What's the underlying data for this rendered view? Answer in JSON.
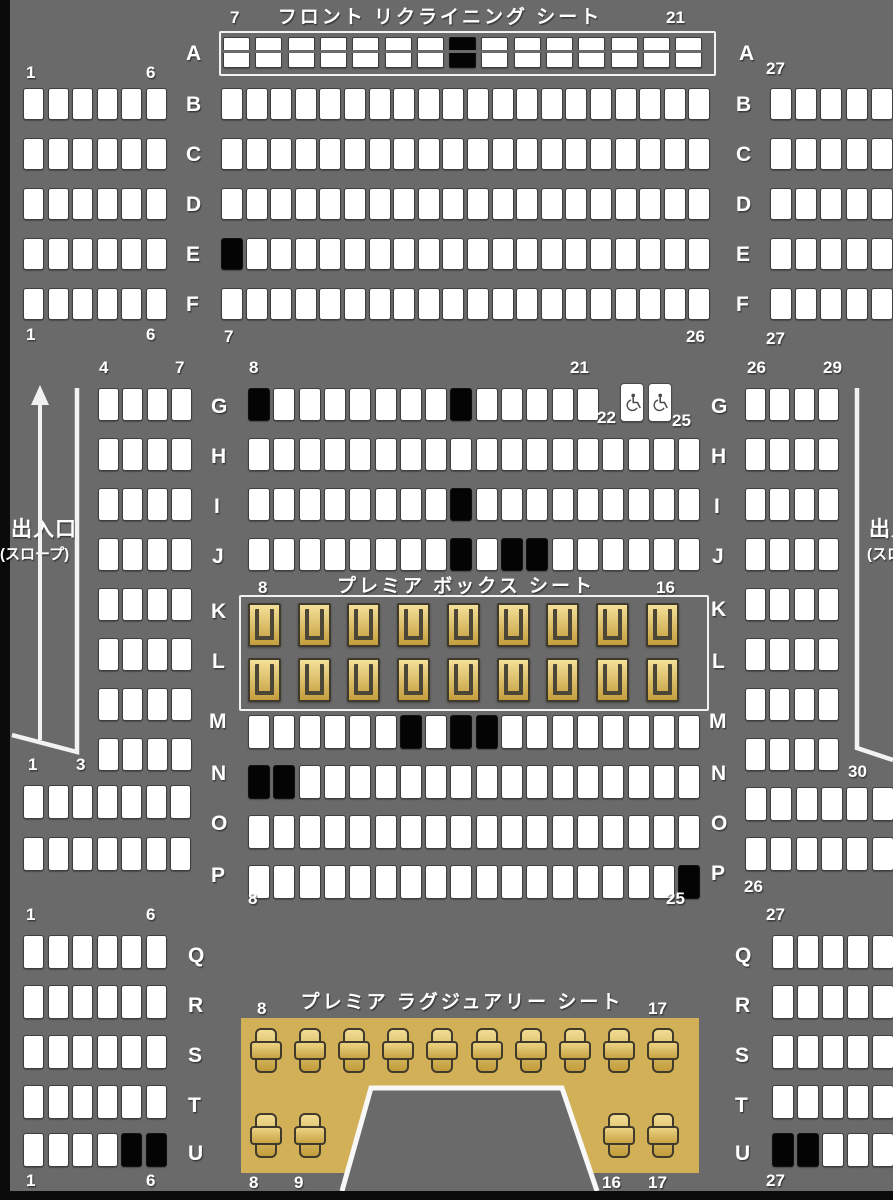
{
  "titles": {
    "front": "フロント リクライニング シート",
    "box": "プレミア ボックス シート",
    "luxury": "プレミア ラグジュアリー シート"
  },
  "exits": {
    "left": {
      "line1": "出入口",
      "line2": "(スロープ)"
    },
    "right": {
      "line1": "出入口",
      "line2": "(スロープ)"
    }
  },
  "colors": {
    "background": "#6a6a6a",
    "seat_available": "#ffffff",
    "seat_occupied": "#040404",
    "seat_border": "#3e3e3e",
    "premium_gold_light": "#f4e098",
    "premium_gold_dark": "#c49e3c",
    "luxury_area": "#d2b057",
    "label_text": "#ffffff",
    "frame_border": "#f2f2f2"
  },
  "blocks": [
    {
      "id": "front-A",
      "type": "recliner",
      "x": 223,
      "pitch": 32.3,
      "w": 27,
      "h": 31,
      "rows": [
        {
          "row": "A",
          "y": 37,
          "start": 7,
          "count": 15,
          "occupied": [
            14
          ]
        }
      ]
    },
    {
      "id": "left-BF",
      "type": "standard",
      "x": 23,
      "pitch": 24.5,
      "w": 21,
      "h": 32,
      "rows": [
        {
          "row": "B",
          "y": 88,
          "start": 1,
          "count": 6,
          "occupied": []
        },
        {
          "row": "C",
          "y": 138,
          "start": 1,
          "count": 6,
          "occupied": []
        },
        {
          "row": "D",
          "y": 188,
          "start": 1,
          "count": 6,
          "occupied": []
        },
        {
          "row": "E",
          "y": 238,
          "start": 1,
          "count": 6,
          "occupied": []
        },
        {
          "row": "F",
          "y": 288,
          "start": 1,
          "count": 6,
          "occupied": []
        }
      ]
    },
    {
      "id": "center-BF",
      "type": "standard",
      "x": 221,
      "pitch": 24.6,
      "w": 22,
      "h": 32,
      "rows": [
        {
          "row": "B",
          "y": 88,
          "start": 7,
          "count": 20,
          "occupied": []
        },
        {
          "row": "C",
          "y": 138,
          "start": 7,
          "count": 20,
          "occupied": []
        },
        {
          "row": "D",
          "y": 188,
          "start": 7,
          "count": 20,
          "occupied": []
        },
        {
          "row": "E",
          "y": 238,
          "start": 7,
          "count": 20,
          "occupied": [
            7
          ]
        },
        {
          "row": "F",
          "y": 288,
          "start": 7,
          "count": 20,
          "occupied": []
        }
      ]
    },
    {
      "id": "right-BF",
      "type": "standard",
      "x": 770,
      "pitch": 25.2,
      "w": 22,
      "h": 32,
      "rows": [
        {
          "row": "B",
          "y": 88,
          "start": 27,
          "count": 6,
          "occupied": []
        },
        {
          "row": "C",
          "y": 138,
          "start": 27,
          "count": 6,
          "occupied": []
        },
        {
          "row": "D",
          "y": 188,
          "start": 27,
          "count": 6,
          "occupied": []
        },
        {
          "row": "E",
          "y": 238,
          "start": 27,
          "count": 6,
          "occupied": []
        },
        {
          "row": "F",
          "y": 288,
          "start": 27,
          "count": 6,
          "occupied": []
        }
      ]
    },
    {
      "id": "left-GN",
      "type": "standard",
      "x": 98,
      "pitch": 24.4,
      "w": 21,
      "h": 33,
      "rows": [
        {
          "row": "G",
          "y": 388,
          "start": 4,
          "count": 4,
          "occupied": []
        },
        {
          "row": "H",
          "y": 438,
          "start": 4,
          "count": 4,
          "occupied": []
        },
        {
          "row": "I",
          "y": 488,
          "start": 4,
          "count": 4,
          "occupied": []
        },
        {
          "row": "J",
          "y": 538,
          "start": 4,
          "count": 4,
          "occupied": []
        },
        {
          "row": "K",
          "y": 588,
          "start": 4,
          "count": 4,
          "occupied": []
        },
        {
          "row": "L",
          "y": 638,
          "start": 4,
          "count": 4,
          "occupied": []
        },
        {
          "row": "M",
          "y": 688,
          "start": 4,
          "count": 4,
          "occupied": []
        },
        {
          "row": "N",
          "y": 738,
          "start": 4,
          "count": 4,
          "occupied": []
        }
      ]
    },
    {
      "id": "right-GN",
      "type": "standard",
      "x": 745,
      "pitch": 24.4,
      "w": 21,
      "h": 33,
      "rows": [
        {
          "row": "G",
          "y": 388,
          "start": 26,
          "count": 4,
          "occupied": []
        },
        {
          "row": "H",
          "y": 438,
          "start": 26,
          "count": 4,
          "occupied": []
        },
        {
          "row": "I",
          "y": 488,
          "start": 26,
          "count": 4,
          "occupied": []
        },
        {
          "row": "J",
          "y": 538,
          "start": 26,
          "count": 4,
          "occupied": []
        },
        {
          "row": "K",
          "y": 588,
          "start": 26,
          "count": 4,
          "occupied": []
        },
        {
          "row": "L",
          "y": 638,
          "start": 26,
          "count": 4,
          "occupied": []
        },
        {
          "row": "M",
          "y": 688,
          "start": 26,
          "count": 4,
          "occupied": []
        },
        {
          "row": "N",
          "y": 738,
          "start": 26,
          "count": 4,
          "occupied": []
        }
      ]
    },
    {
      "id": "center-G",
      "type": "standard",
      "x": 248,
      "pitch": 25.3,
      "w": 22,
      "h": 33,
      "rows": [
        {
          "row": "G",
          "y": 388,
          "start": 8,
          "count": 14,
          "occupied": [
            8,
            16
          ]
        }
      ]
    },
    {
      "id": "wheelchair-G",
      "type": "wheelchair",
      "x": 620,
      "pitch": 27.5,
      "w": 24,
      "h": 39,
      "rows": [
        {
          "row": "G",
          "y": 383,
          "start": 23,
          "count": 2,
          "occupied": []
        }
      ]
    },
    {
      "id": "center-HIJ",
      "type": "standard",
      "x": 248,
      "pitch": 25.3,
      "w": 22,
      "h": 33,
      "rows": [
        {
          "row": "H",
          "y": 438,
          "start": 8,
          "count": 18,
          "occupied": []
        },
        {
          "row": "I",
          "y": 488,
          "start": 8,
          "count": 18,
          "occupied": [
            16
          ]
        },
        {
          "row": "J",
          "y": 538,
          "start": 8,
          "count": 18,
          "occupied": [
            16,
            18,
            19
          ]
        }
      ]
    },
    {
      "id": "box-KL",
      "type": "box",
      "x": 248,
      "pitch": 49.7,
      "w": 33,
      "h": 44,
      "rows": [
        {
          "row": "K",
          "y": 603,
          "start": 8,
          "count": 9,
          "occupied": []
        },
        {
          "row": "L",
          "y": 658,
          "start": 8,
          "count": 9,
          "occupied": []
        }
      ]
    },
    {
      "id": "center-MNOP",
      "type": "standard",
      "x": 248,
      "pitch": 25.3,
      "w": 22,
      "h": 34,
      "rows": [
        {
          "row": "M",
          "y": 715,
          "start": 8,
          "count": 18,
          "occupied": [
            14,
            16,
            17
          ]
        },
        {
          "row": "N",
          "y": 765,
          "start": 8,
          "count": 18,
          "occupied": [
            8,
            9
          ]
        },
        {
          "row": "O",
          "y": 815,
          "start": 8,
          "count": 18,
          "occupied": []
        },
        {
          "row": "P",
          "y": 865,
          "start": 8,
          "count": 18,
          "occupied": [
            25
          ]
        }
      ]
    },
    {
      "id": "left-OP",
      "type": "standard",
      "x": 23,
      "pitch": 24.5,
      "w": 21,
      "h": 34,
      "rows": [
        {
          "row": "O",
          "y": 785,
          "start": 1,
          "count": 7,
          "occupied": []
        },
        {
          "row": "P",
          "y": 837,
          "start": 1,
          "count": 7,
          "occupied": []
        }
      ]
    },
    {
      "id": "right-OP",
      "type": "standard",
      "x": 745,
      "pitch": 25.3,
      "w": 22,
      "h": 34,
      "rows": [
        {
          "row": "O",
          "y": 787,
          "start": 26,
          "count": 6,
          "occupied": []
        },
        {
          "row": "P",
          "y": 837,
          "start": 26,
          "count": 6,
          "occupied": []
        }
      ]
    },
    {
      "id": "left-QU",
      "type": "standard",
      "x": 23,
      "pitch": 24.5,
      "w": 21,
      "h": 34,
      "rows": [
        {
          "row": "Q",
          "y": 935,
          "start": 1,
          "count": 6,
          "occupied": []
        },
        {
          "row": "R",
          "y": 985,
          "start": 1,
          "count": 6,
          "occupied": []
        },
        {
          "row": "S",
          "y": 1035,
          "start": 1,
          "count": 6,
          "occupied": []
        },
        {
          "row": "T",
          "y": 1085,
          "start": 1,
          "count": 6,
          "occupied": []
        },
        {
          "row": "U",
          "y": 1133,
          "start": 1,
          "count": 6,
          "occupied": [
            5,
            6
          ]
        }
      ]
    },
    {
      "id": "right-QU",
      "type": "standard",
      "x": 772,
      "pitch": 25,
      "w": 22,
      "h": 34,
      "rows": [
        {
          "row": "Q",
          "y": 935,
          "start": 27,
          "count": 6,
          "occupied": []
        },
        {
          "row": "R",
          "y": 985,
          "start": 27,
          "count": 6,
          "occupied": []
        },
        {
          "row": "S",
          "y": 1035,
          "start": 27,
          "count": 6,
          "occupied": []
        },
        {
          "row": "T",
          "y": 1085,
          "start": 27,
          "count": 6,
          "occupied": []
        },
        {
          "row": "U",
          "y": 1133,
          "start": 27,
          "count": 6,
          "occupied": [
            27,
            28
          ]
        }
      ]
    },
    {
      "id": "lux-top",
      "type": "luxury",
      "x": 250,
      "pitch": 44.1,
      "w": 32,
      "h": 45,
      "rows": [
        {
          "row": "S",
          "y": 1028,
          "start": 8,
          "count": 10,
          "occupied": []
        }
      ]
    },
    {
      "id": "lux-bottom-left",
      "type": "luxury",
      "x": 250,
      "pitch": 44.1,
      "w": 32,
      "h": 45,
      "rows": [
        {
          "row": "U",
          "y": 1113,
          "start": 8,
          "count": 2,
          "occupied": []
        }
      ]
    },
    {
      "id": "lux-bottom-right",
      "type": "luxury",
      "x": 603,
      "pitch": 44.1,
      "w": 32,
      "h": 45,
      "rows": [
        {
          "row": "U",
          "y": 1113,
          "start": 16,
          "count": 2,
          "occupied": []
        }
      ]
    }
  ],
  "labels": [
    {
      "t": "7",
      "x": 230,
      "y": 9
    },
    {
      "t": "21",
      "x": 666,
      "y": 9
    },
    {
      "t": "A",
      "x": 186,
      "y": 42,
      "cls": "letter"
    },
    {
      "t": "A",
      "x": 739,
      "y": 42,
      "cls": "letter"
    },
    {
      "t": "1",
      "x": 26,
      "y": 64
    },
    {
      "t": "6",
      "x": 146,
      "y": 64
    },
    {
      "t": "27",
      "x": 766,
      "y": 60
    },
    {
      "t": "B",
      "x": 186,
      "y": 93,
      "cls": "letter"
    },
    {
      "t": "B",
      "x": 736,
      "y": 93,
      "cls": "letter"
    },
    {
      "t": "C",
      "x": 186,
      "y": 143,
      "cls": "letter"
    },
    {
      "t": "C",
      "x": 736,
      "y": 143,
      "cls": "letter"
    },
    {
      "t": "D",
      "x": 186,
      "y": 193,
      "cls": "letter"
    },
    {
      "t": "D",
      "x": 736,
      "y": 193,
      "cls": "letter"
    },
    {
      "t": "E",
      "x": 186,
      "y": 243,
      "cls": "letter"
    },
    {
      "t": "E",
      "x": 736,
      "y": 243,
      "cls": "letter"
    },
    {
      "t": "F",
      "x": 186,
      "y": 293,
      "cls": "letter"
    },
    {
      "t": "F",
      "x": 736,
      "y": 293,
      "cls": "letter"
    },
    {
      "t": "1",
      "x": 26,
      "y": 326
    },
    {
      "t": "6",
      "x": 146,
      "y": 326
    },
    {
      "t": "7",
      "x": 224,
      "y": 328
    },
    {
      "t": "26",
      "x": 686,
      "y": 328
    },
    {
      "t": "27",
      "x": 766,
      "y": 330
    },
    {
      "t": "4",
      "x": 99,
      "y": 359
    },
    {
      "t": "7",
      "x": 175,
      "y": 359
    },
    {
      "t": "8",
      "x": 249,
      "y": 359
    },
    {
      "t": "21",
      "x": 570,
      "y": 359
    },
    {
      "t": "26",
      "x": 747,
      "y": 359
    },
    {
      "t": "29",
      "x": 823,
      "y": 359
    },
    {
      "t": "22",
      "x": 597,
      "y": 409
    },
    {
      "t": "25",
      "x": 672,
      "y": 412
    },
    {
      "t": "G",
      "x": 211,
      "y": 395,
      "cls": "letter"
    },
    {
      "t": "G",
      "x": 711,
      "y": 395,
      "cls": "letter"
    },
    {
      "t": "H",
      "x": 211,
      "y": 445,
      "cls": "letter"
    },
    {
      "t": "H",
      "x": 711,
      "y": 445,
      "cls": "letter"
    },
    {
      "t": "I",
      "x": 214,
      "y": 495,
      "cls": "letter"
    },
    {
      "t": "I",
      "x": 714,
      "y": 495,
      "cls": "letter"
    },
    {
      "t": "J",
      "x": 212,
      "y": 545,
      "cls": "letter"
    },
    {
      "t": "J",
      "x": 712,
      "y": 545,
      "cls": "letter"
    },
    {
      "t": "K",
      "x": 211,
      "y": 600,
      "cls": "letter"
    },
    {
      "t": "K",
      "x": 711,
      "y": 598,
      "cls": "letter"
    },
    {
      "t": "L",
      "x": 212,
      "y": 650,
      "cls": "letter"
    },
    {
      "t": "L",
      "x": 712,
      "y": 650,
      "cls": "letter"
    },
    {
      "t": "M",
      "x": 209,
      "y": 710,
      "cls": "letter"
    },
    {
      "t": "M",
      "x": 709,
      "y": 710,
      "cls": "letter"
    },
    {
      "t": "N",
      "x": 211,
      "y": 762,
      "cls": "letter"
    },
    {
      "t": "N",
      "x": 711,
      "y": 762,
      "cls": "letter"
    },
    {
      "t": "O",
      "x": 211,
      "y": 812,
      "cls": "letter"
    },
    {
      "t": "O",
      "x": 711,
      "y": 812,
      "cls": "letter"
    },
    {
      "t": "P",
      "x": 211,
      "y": 864,
      "cls": "letter"
    },
    {
      "t": "P",
      "x": 711,
      "y": 862,
      "cls": "letter"
    },
    {
      "t": "1",
      "x": 28,
      "y": 756
    },
    {
      "t": "3",
      "x": 76,
      "y": 756
    },
    {
      "t": "30",
      "x": 848,
      "y": 763
    },
    {
      "t": "8",
      "x": 258,
      "y": 579
    },
    {
      "t": "16",
      "x": 656,
      "y": 579
    },
    {
      "t": "8",
      "x": 248,
      "y": 890
    },
    {
      "t": "25",
      "x": 666,
      "y": 890
    },
    {
      "t": "26",
      "x": 744,
      "y": 878
    },
    {
      "t": "1",
      "x": 26,
      "y": 906
    },
    {
      "t": "6",
      "x": 146,
      "y": 906
    },
    {
      "t": "27",
      "x": 766,
      "y": 906
    },
    {
      "t": "Q",
      "x": 188,
      "y": 944,
      "cls": "letter"
    },
    {
      "t": "Q",
      "x": 735,
      "y": 944,
      "cls": "letter"
    },
    {
      "t": "R",
      "x": 188,
      "y": 994,
      "cls": "letter"
    },
    {
      "t": "R",
      "x": 735,
      "y": 994,
      "cls": "letter"
    },
    {
      "t": "S",
      "x": 188,
      "y": 1044,
      "cls": "letter"
    },
    {
      "t": "S",
      "x": 735,
      "y": 1044,
      "cls": "letter"
    },
    {
      "t": "T",
      "x": 188,
      "y": 1094,
      "cls": "letter"
    },
    {
      "t": "T",
      "x": 735,
      "y": 1094,
      "cls": "letter"
    },
    {
      "t": "U",
      "x": 188,
      "y": 1142,
      "cls": "letter"
    },
    {
      "t": "U",
      "x": 735,
      "y": 1142,
      "cls": "letter"
    },
    {
      "t": "1",
      "x": 26,
      "y": 1172
    },
    {
      "t": "6",
      "x": 146,
      "y": 1172
    },
    {
      "t": "27",
      "x": 766,
      "y": 1172
    },
    {
      "t": "8",
      "x": 257,
      "y": 1000
    },
    {
      "t": "17",
      "x": 648,
      "y": 1000
    },
    {
      "t": "8",
      "x": 249,
      "y": 1174
    },
    {
      "t": "9",
      "x": 294,
      "y": 1174
    },
    {
      "t": "16",
      "x": 602,
      "y": 1174
    },
    {
      "t": "17",
      "x": 648,
      "y": 1174
    }
  ]
}
